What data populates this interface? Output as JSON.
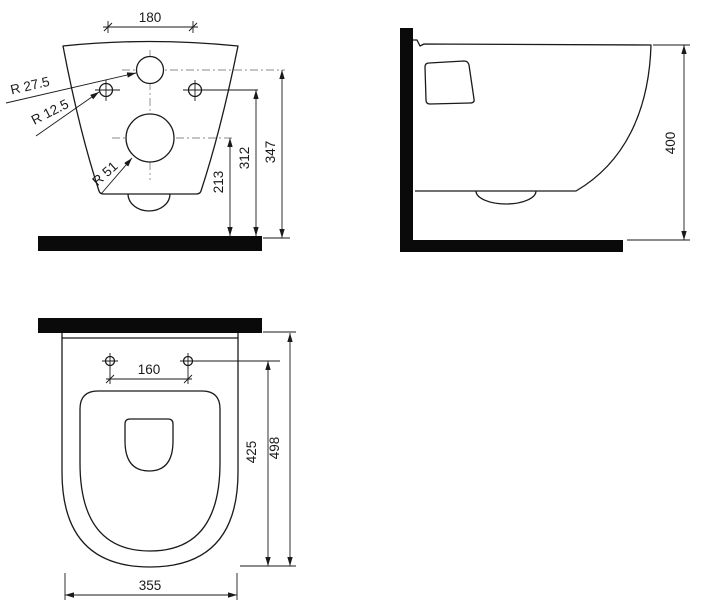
{
  "drawing": {
    "front_view": {
      "top_width": "180",
      "inlet_radius": "R 27.5",
      "fixing_radius": "R 12.5",
      "drain_radius": "R 51",
      "drain_height": "213",
      "fixing_height": "312",
      "inlet_height": "347"
    },
    "side_view": {
      "height": "400"
    },
    "top_view": {
      "seat_hole_spacing": "160",
      "bowl_length": "425",
      "total_depth": "498",
      "width": "355"
    },
    "colors": {
      "line": "#1a1a1a",
      "centerline": "#8a8a8a",
      "wall_fill": "#0a0a0a",
      "background": "#ffffff"
    }
  }
}
